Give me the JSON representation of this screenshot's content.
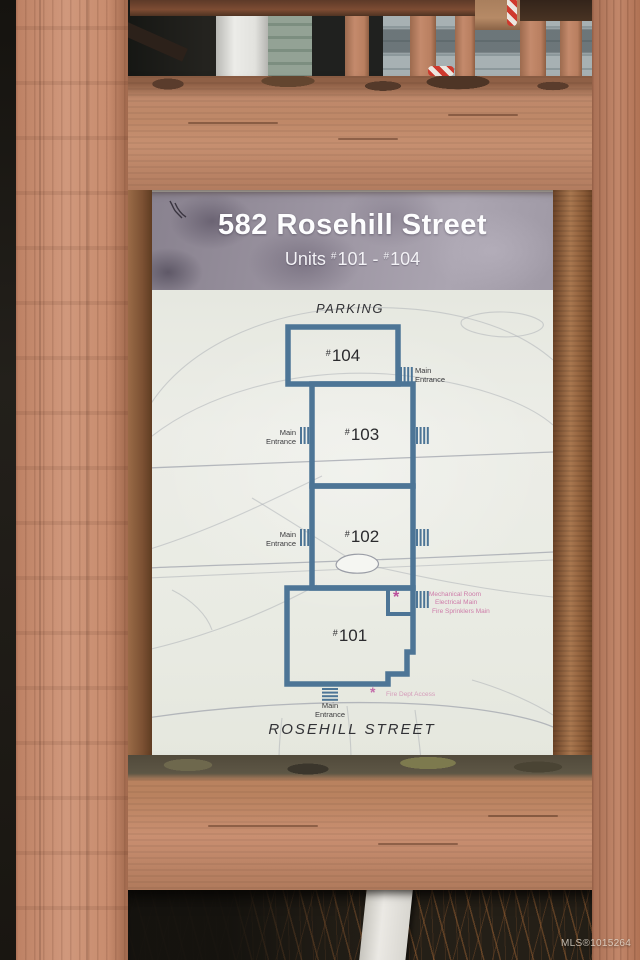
{
  "photo": {
    "watermark": "MLS®1015264"
  },
  "sign": {
    "header": {
      "title": "582 Rosehill Street",
      "units_word": "Units",
      "hash": "#",
      "num_a": "101",
      "sep": " - ",
      "num_b": "104"
    },
    "map": {
      "parking_label": "PARKING",
      "street_label": "ROSEHILL STREET",
      "entrance_label": "Main Entrance",
      "hash": "#",
      "units": [
        {
          "number": "104"
        },
        {
          "number": "103"
        },
        {
          "number": "102"
        },
        {
          "number": "101"
        }
      ],
      "asterisk": "*",
      "mech_note_lines": [
        "Mechanical Room",
        "Electrical Main",
        "Fire Sprinklers Main"
      ],
      "fire_note": "Fire Dept Access"
    }
  },
  "colors": {
    "unit_outline": "#4d7596",
    "map_line": "#a9adb4",
    "note_pink": "#c9699f",
    "sign_bg": "#e9ebe3",
    "header_bg": "#9d96a3",
    "wood": "#c78e6f"
  }
}
